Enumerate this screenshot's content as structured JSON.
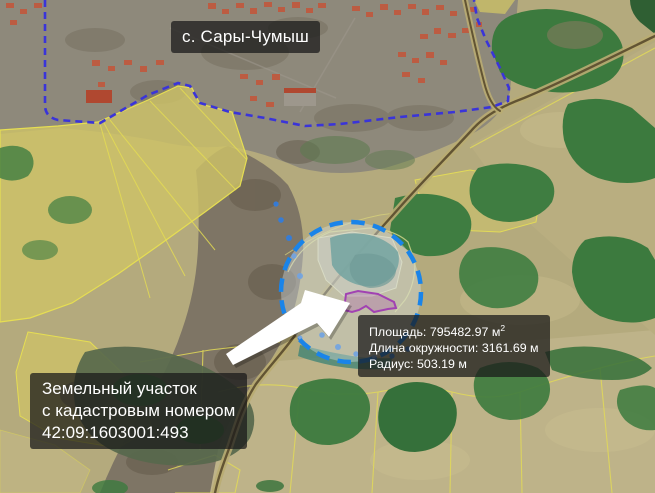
{
  "map": {
    "village_label": "с. Сары-Чумыш",
    "measurement_info": {
      "area_text": "Площадь: 795482.97 м",
      "area_superscript": "2",
      "circumference_text": "Длина окружности: 3161.69 м",
      "radius_text": "Радиус: 503.19 м"
    },
    "parcel_info": {
      "line1": "Земельный участок",
      "line2": "с кадастровым номером",
      "line3": "42:09:1603001:493"
    },
    "cadastral_number": "42:09:1603001:493",
    "colors": {
      "village_boundary": "#3a34d9",
      "measure_circle": "#1a84e9",
      "parcel_outline": "#a142b2",
      "parcel_fill": "rgba(170,70,180,0.25)",
      "arrow": "#ffffff",
      "label_background": "rgba(25,25,25,0.74)",
      "label_text": "#ffffff",
      "water": "#2f7de2"
    }
  }
}
